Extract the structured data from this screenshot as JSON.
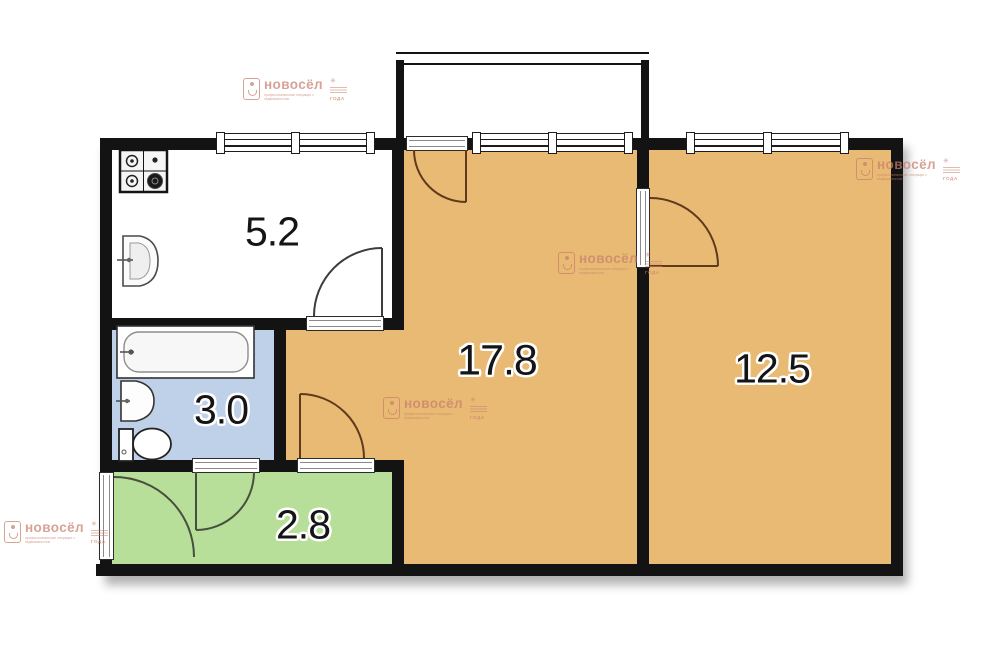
{
  "floorplan": {
    "rooms": [
      {
        "name": "kitchen",
        "area": "5.2",
        "floor_color": "#ffffff"
      },
      {
        "name": "bathroom",
        "area": "3.0",
        "floor_color": "#bfd1e8"
      },
      {
        "name": "hallway",
        "area": "2.8",
        "floor_color": "#b7df99"
      },
      {
        "name": "living-room",
        "area": "17.8",
        "floor_color": "#e9ba73"
      },
      {
        "name": "bedroom",
        "area": "12.5",
        "floor_color": "#e9ba73"
      }
    ],
    "colors": {
      "wall": "#131313",
      "orange_room": "#e9ba73",
      "blue_room": "#bfd1e8",
      "green_room": "#b7df99",
      "watermark": "#c97f6e"
    },
    "fixtures": [
      "gas-stove",
      "kitchen-sink",
      "bathtub",
      "washbasin",
      "toilet"
    ],
    "features": [
      "balcony",
      "balcony-door",
      "windows",
      "door-arcs",
      "entry-door"
    ]
  },
  "watermark": {
    "brand": "новосёл",
    "tagline": "профессиональные операции с недвижимостью",
    "award": "ГОДА"
  }
}
